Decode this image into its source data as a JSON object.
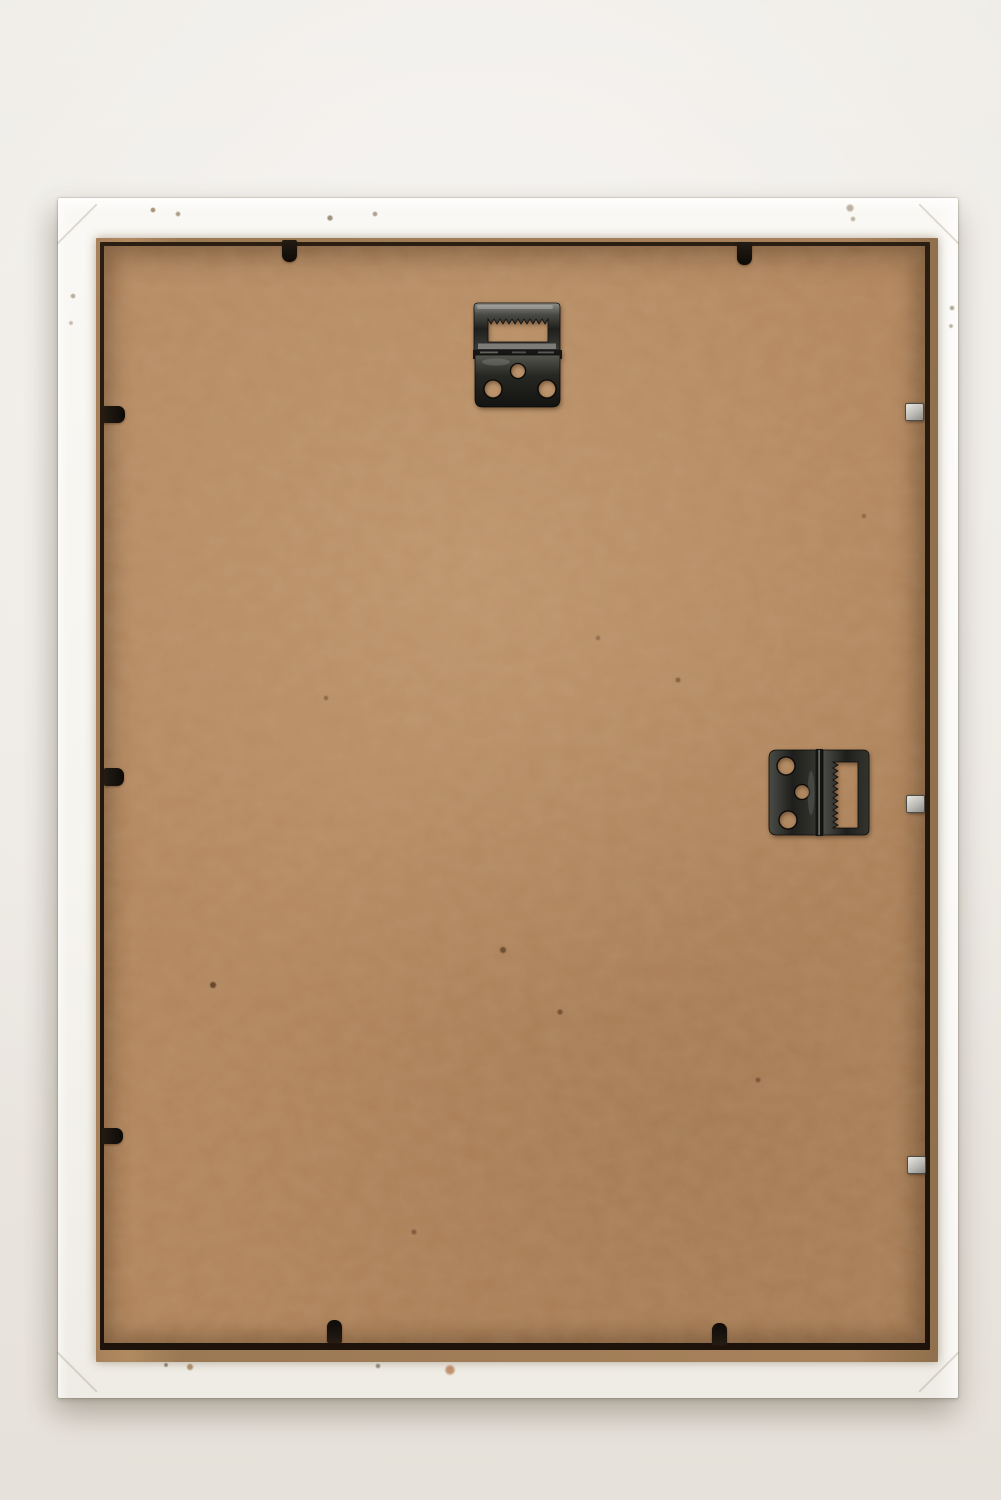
{
  "scene": {
    "title": "Back view of an empty white wooden picture frame photographed against a pale wall",
    "background_color": "#ece8e2",
    "frame": {
      "label": "white wooden frame with chipped paint specks",
      "color": "#f6f4ee"
    },
    "lip": {
      "label": "raw wood rebate edge",
      "color": "#a8825b"
    },
    "backing": {
      "label": "brown hardboard backing panel",
      "color": "#b2845a"
    },
    "hardware": {
      "metal_color": "#2e2e2b",
      "top_hanger": {
        "label": "hinged sawtooth hanger, slot facing up, three empty screw holes",
        "screw_holes": 3
      },
      "right_hanger": {
        "label": "hinged sawtooth hanger, slot facing right, three empty screw holes",
        "screw_holes": 3
      },
      "black_tabs": {
        "label": "black retaining tab",
        "count": 7,
        "placement": "2 top, 3 left, 2 bottom"
      },
      "silver_points": {
        "label": "silver glazing point",
        "count": 3,
        "placement": "right edge"
      }
    }
  }
}
